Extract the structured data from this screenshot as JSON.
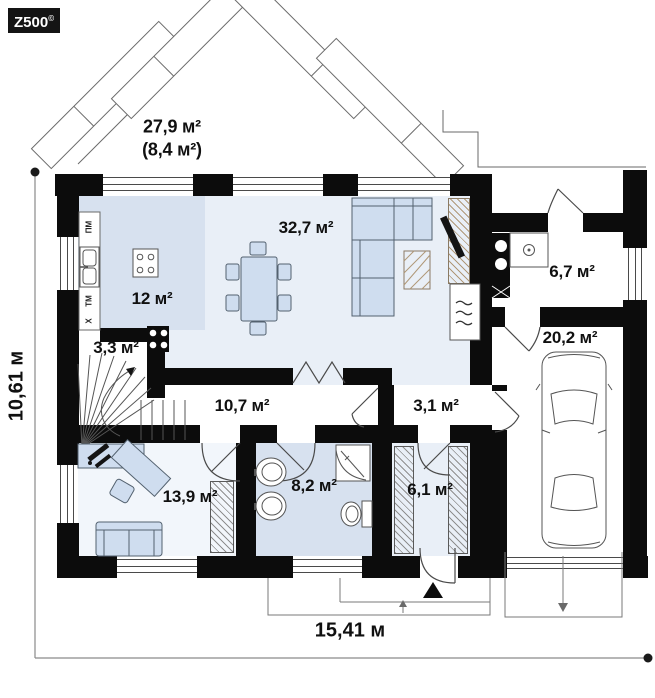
{
  "logo": {
    "brand": "Z500",
    "copyright": "©"
  },
  "terrace": {
    "area": "27,9 м²",
    "area_alt": "(8,4 м²)"
  },
  "rooms": {
    "living": "32,7 м²",
    "kitchen": "12 м²",
    "stairs": "3,3 м²",
    "hall": "10,7 м²",
    "passage": "3,1 м²",
    "utility": "6,7 м²",
    "garage": "20,2 м²",
    "office": "13,9 м²",
    "bathroom": "8,2 м²",
    "vestibule": "6,1 м²"
  },
  "kitchen_appliances": {
    "dishwasher": "ПМ",
    "washing_machine": "ТМ",
    "fridge": "Х"
  },
  "dimensions": {
    "total_width": "15,41 м",
    "total_height": "10,61 м"
  },
  "colors": {
    "wall": "#0c0c0c",
    "floor_accent": "#d7e1ef",
    "floor_light": "#e9eff7",
    "furniture": "#cfddef"
  }
}
